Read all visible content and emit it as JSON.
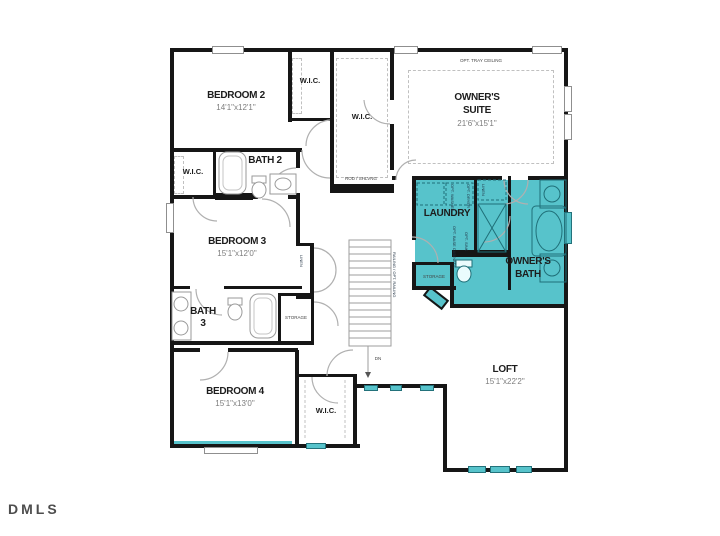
{
  "watermark": "DMLS",
  "rooms": {
    "bedroom2": {
      "label": "BEDROOM 2",
      "dims": "14'1\"x12'1\""
    },
    "wic_bedroom2": {
      "label": "W.I.C."
    },
    "owners_wic": {
      "label": "W.I.C.",
      "shelf_note": "ROD / SHLVNG"
    },
    "owners_suite": {
      "label1": "OWNER'S",
      "label2": "SUITE",
      "dims": "21'6\"x15'1\"",
      "ceiling_note": "OPT. TRAY CEILING"
    },
    "wic_hall": {
      "label": "W.I.C."
    },
    "bath2": {
      "label": "BATH 2"
    },
    "bedroom3": {
      "label": "BEDROOM 3",
      "dims": "15'1\"x12'0\""
    },
    "linen_hall": {
      "label": "LINEN"
    },
    "bath3": {
      "label1": "BATH",
      "label2": "3"
    },
    "storage_bath3": {
      "label": "STORAGE"
    },
    "bedroom4": {
      "label": "BEDROOM 4",
      "dims": "15'1\"x13'0\""
    },
    "wic_bedroom4": {
      "label": "W.I.C."
    },
    "laundry": {
      "label": "LAUNDRY",
      "opt_washer": "OPT. WASHER",
      "opt_dryer": "OPT. DRYER",
      "opt_base": "OPT. BASE CABINETS",
      "opt_sink": "OPT. SINK"
    },
    "linen_owners": {
      "label": "LINEN"
    },
    "owners_bath": {
      "label1": "OWNER'S",
      "label2": "BATH"
    },
    "storage_owners": {
      "label": "STORAGE"
    },
    "loft": {
      "label": "LOFT",
      "dims": "15'1\"x22'2\""
    }
  },
  "stairs": {
    "down_label": "DN",
    "railing_note": "RAILING / OPT. RAILING"
  },
  "colors": {
    "highlight": "#57c3cb",
    "wall": "#161616"
  }
}
